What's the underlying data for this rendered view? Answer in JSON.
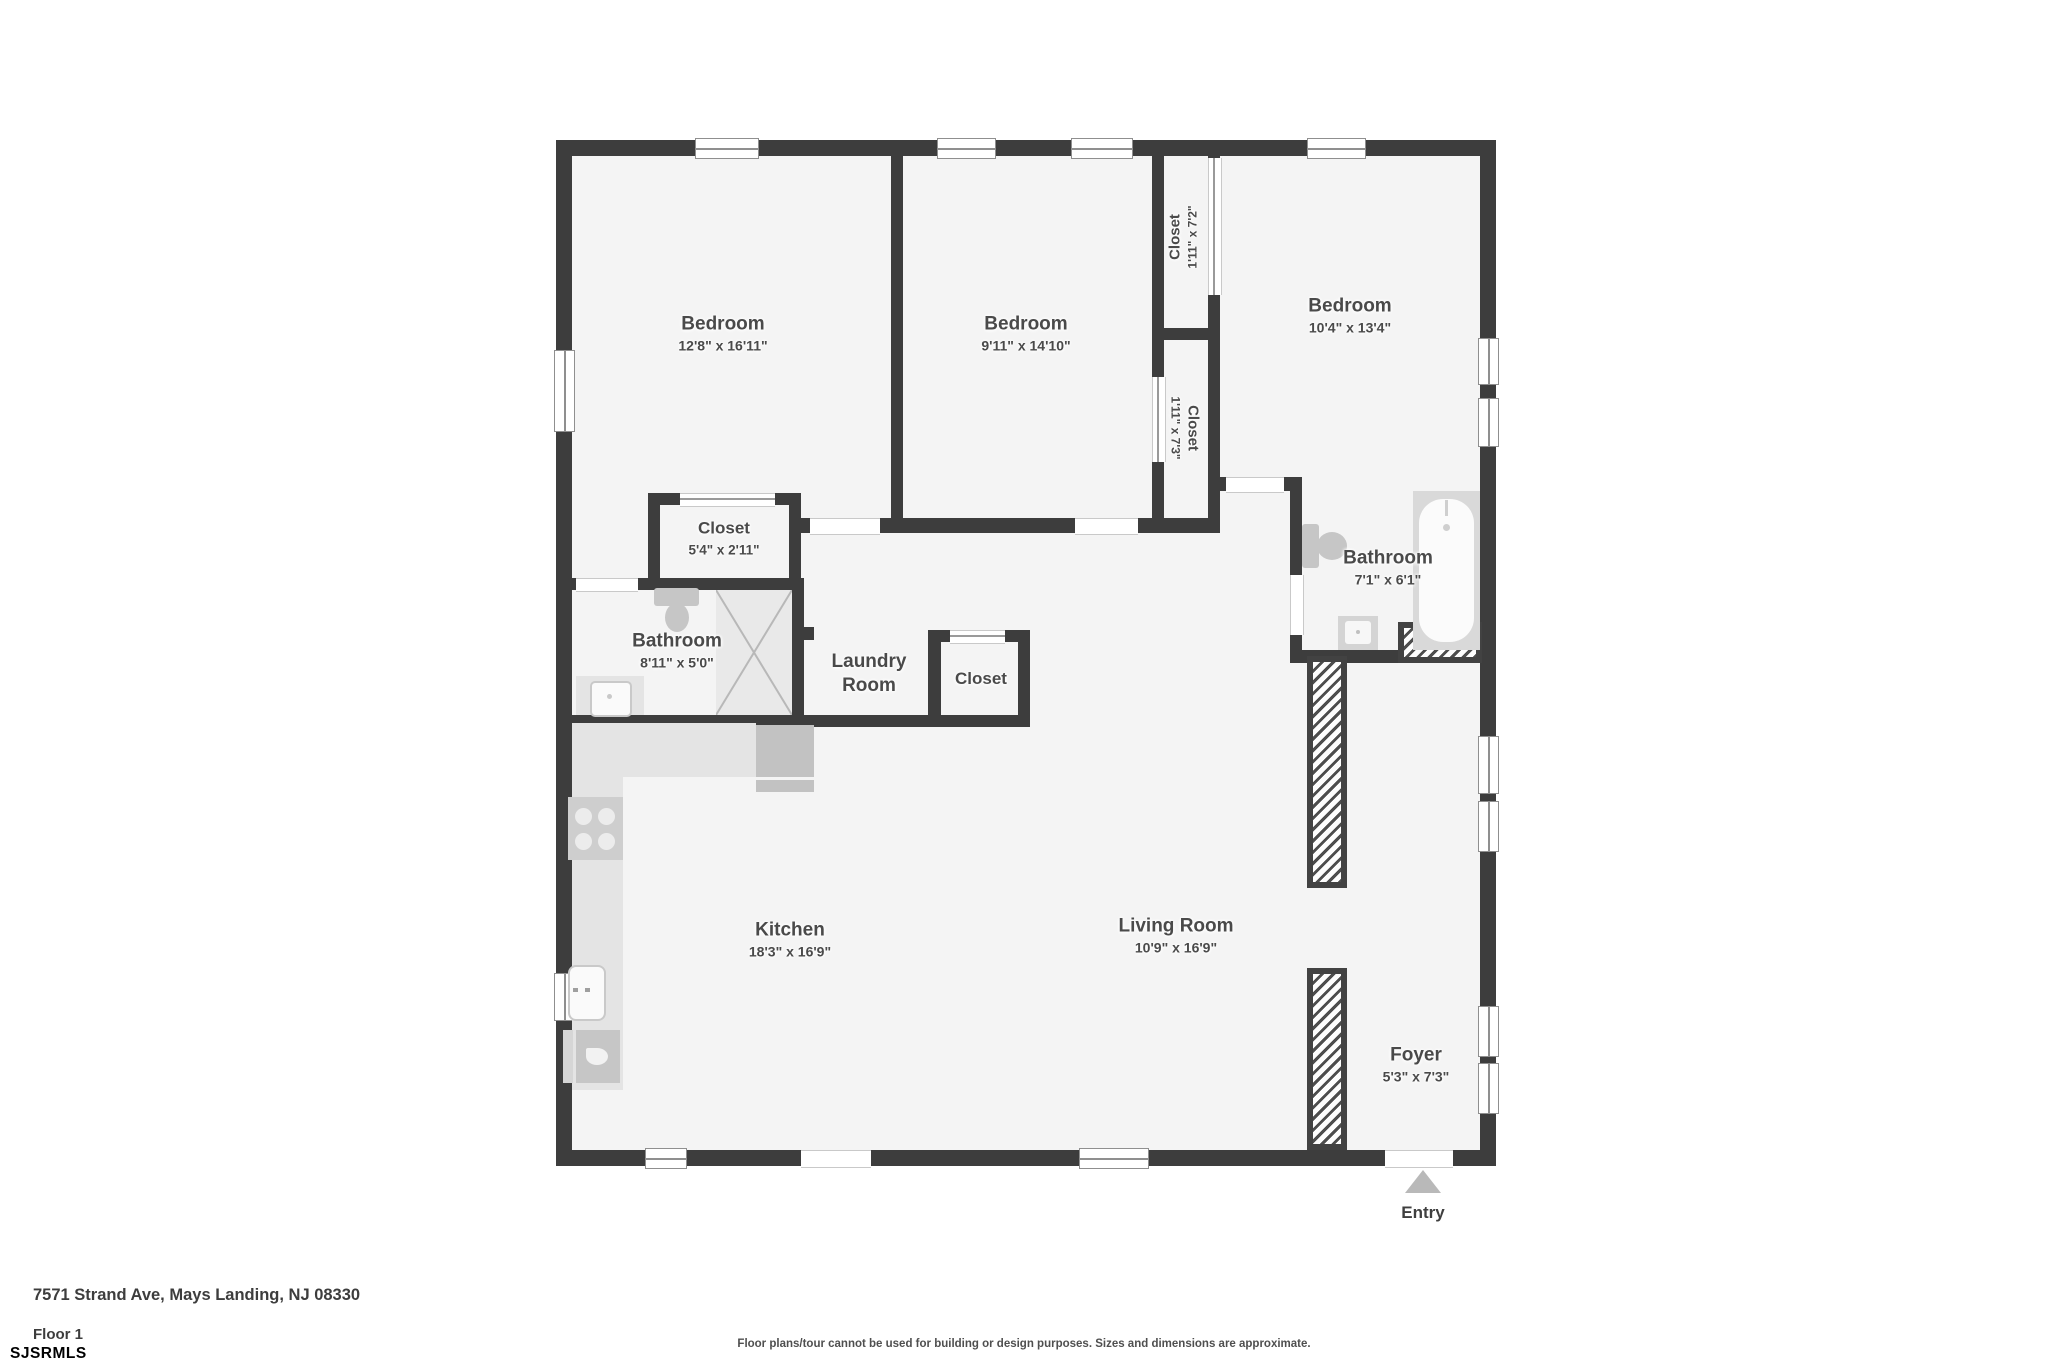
{
  "entry_label": "Entry",
  "footer": {
    "address": "7571 Strand Ave, Mays Landing, NJ 08330",
    "floor_label": "Floor 1",
    "mls_watermark": "SJSRMLS",
    "disclaimer": "Floor plans/tour cannot be used for building or design purposes. Sizes and dimensions are approximate."
  },
  "colors": {
    "wall": "#3d3d3d",
    "floor": "#f4f4f4",
    "fixture_dark": "#c6c6c6",
    "fixture_light": "#e4e4e4",
    "text": "#4a4a4a",
    "entry_arrow": "#b9b9b9"
  },
  "rooms": {
    "bedroom1": {
      "name": "Bedroom",
      "dims": "12'8\" x 16'11\""
    },
    "bedroom2": {
      "name": "Bedroom",
      "dims": "9'11\" x 14'10\""
    },
    "bedroom3": {
      "name": "Bedroom",
      "dims": "10'4\" x 13'4\""
    },
    "closet_top": {
      "name": "Closet",
      "dims": "1'11\" x 7'2\""
    },
    "closet_mid": {
      "name": "Closet",
      "dims": "1'11\" x 7'3\""
    },
    "closet_54": {
      "name": "Closet",
      "dims": "5'4\" x 2'11\""
    },
    "bathroom1": {
      "name": "Bathroom",
      "dims": "8'11\" x 5'0\""
    },
    "laundry": {
      "name_line1": "Laundry",
      "name_line2": "Room"
    },
    "closet_sm": {
      "name": "Closet"
    },
    "bathroom2": {
      "name": "Bathroom",
      "dims": "7'1\" x 6'1\""
    },
    "kitchen": {
      "name": "Kitchen",
      "dims": "18'3\" x 16'9\""
    },
    "living": {
      "name": "Living Room",
      "dims": "10'9\" x 16'9\""
    },
    "foyer": {
      "name": "Foyer",
      "dims": "5'3\" x 7'3\""
    }
  }
}
